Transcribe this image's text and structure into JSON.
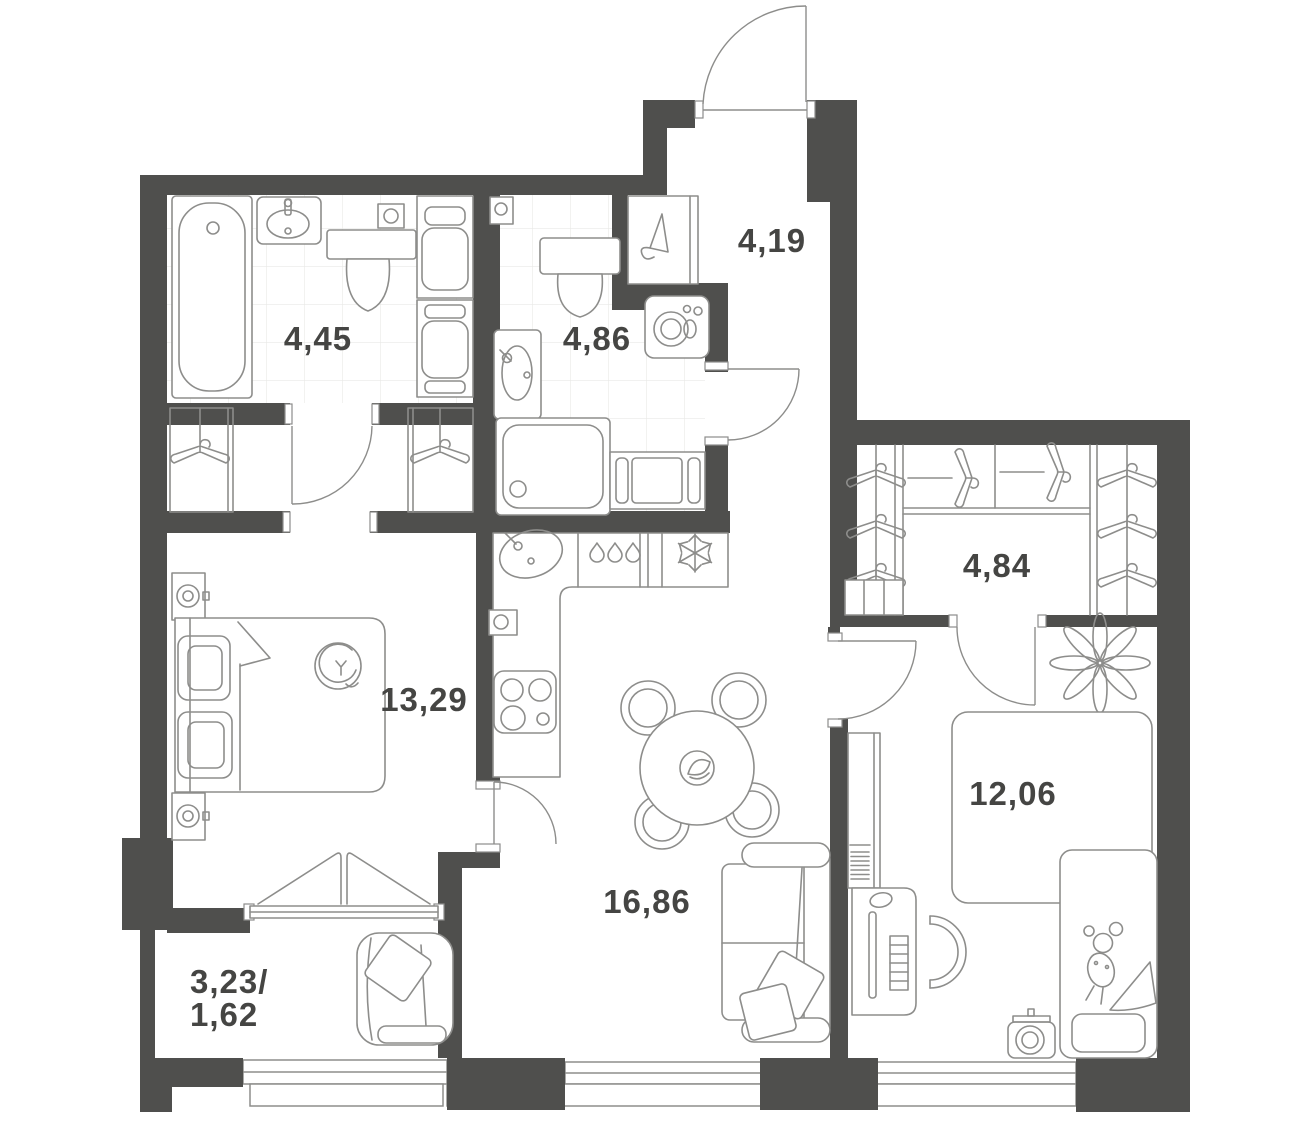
{
  "palette": {
    "wall": "#4f4f4d",
    "line": "#8d8d8b",
    "tile": "#e9e9e7",
    "text": "#454543",
    "white": "#ffffff"
  },
  "rooms": [
    {
      "name": "bathroom-1",
      "area": "4,45"
    },
    {
      "name": "bathroom-2",
      "area": "4,86"
    },
    {
      "name": "hallway",
      "area": "4,19"
    },
    {
      "name": "wardrobe",
      "area": "4,84"
    },
    {
      "name": "bedroom",
      "area": "13,29"
    },
    {
      "name": "living-kitchen",
      "area": "16,86"
    },
    {
      "name": "kids-room",
      "area": "12,06"
    },
    {
      "name": "balcony",
      "area_total": "3,23/",
      "area_reduced": "1,62"
    }
  ]
}
